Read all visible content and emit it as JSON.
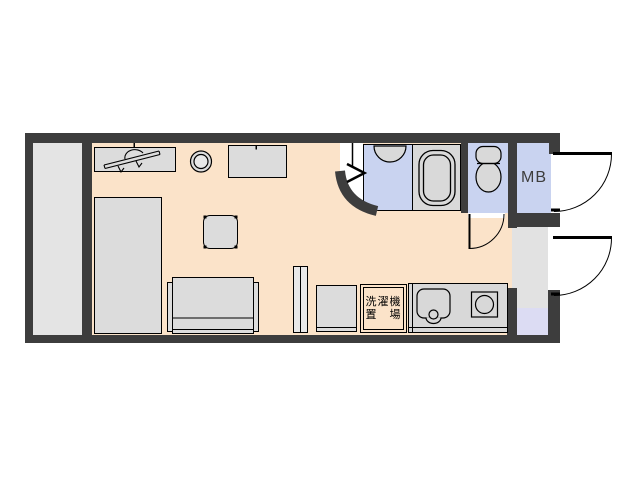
{
  "labels": {
    "meter_box": "MB",
    "laundry_line1": "洗濯機",
    "laundry_line2": "置　場"
  },
  "colors": {
    "wall": "#3d3d3d",
    "floor": "#fbe3c9",
    "wet": "#c9d3f0",
    "closet": "#e4e4e4",
    "entrance": "#e2e2e2",
    "tataki": "#dcdcf3",
    "furniture": "#dcdcdc",
    "fixture": "#d9d9d9",
    "counter": "#d8d8d8",
    "line": "#000000"
  }
}
